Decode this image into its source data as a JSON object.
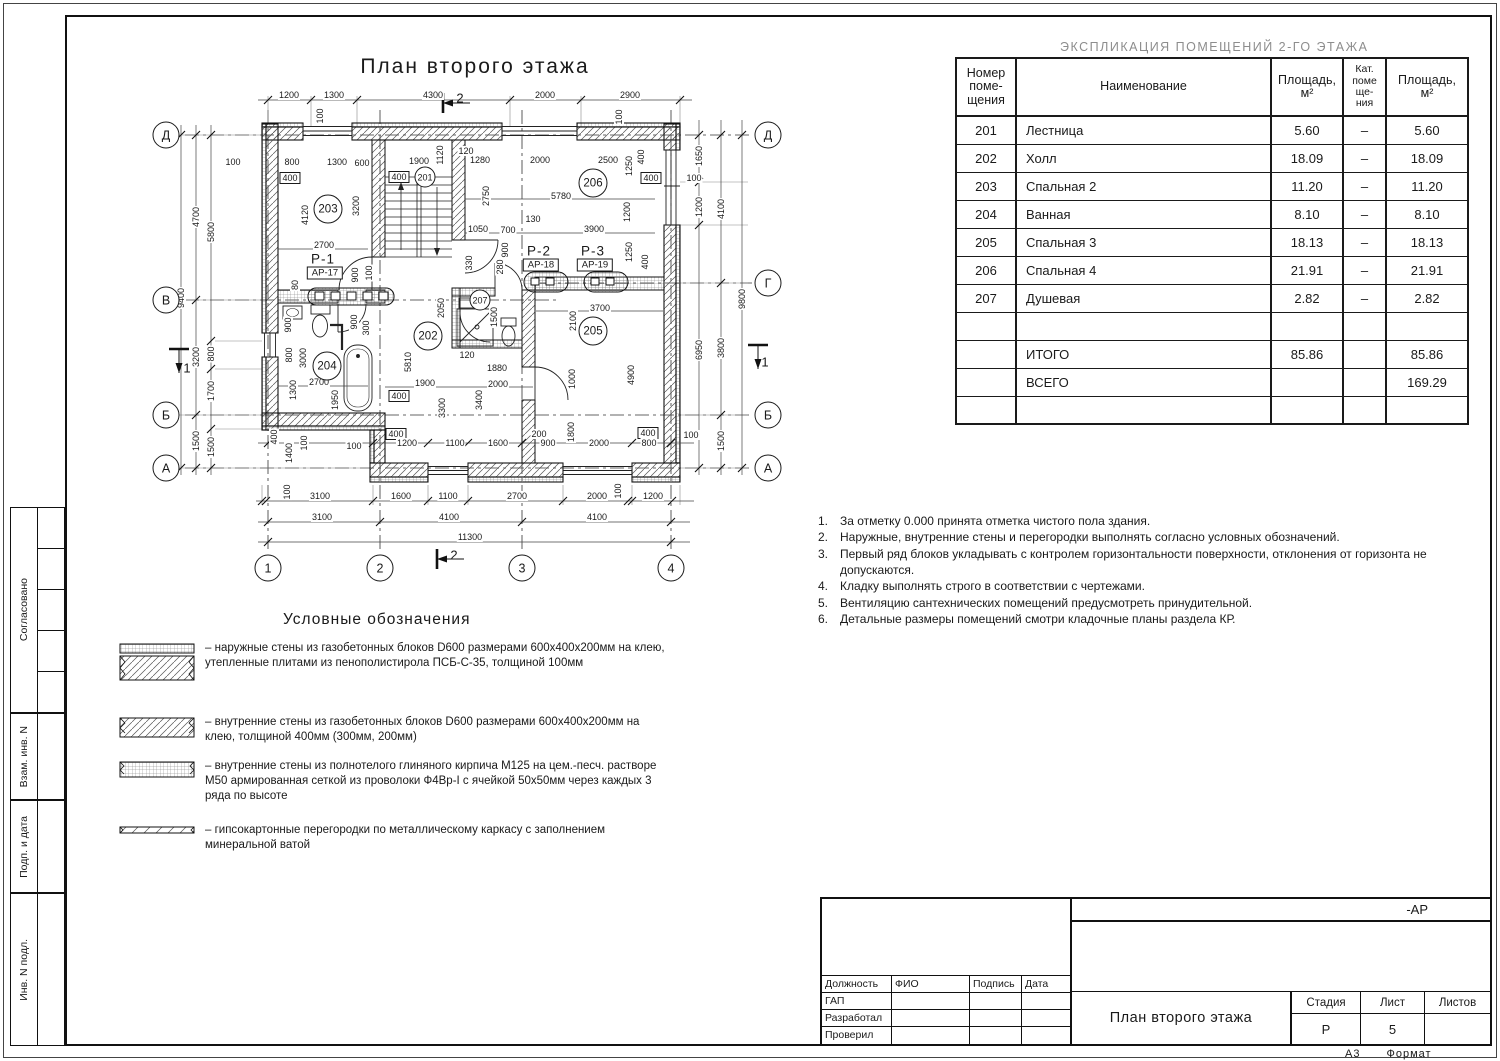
{
  "plan": {
    "title": "План второго этажа",
    "legend_title": "Условные обозначения",
    "axes": [
      {
        "t": "Д",
        "x": 166,
        "y": 135
      },
      {
        "t": "В",
        "x": 166,
        "y": 300
      },
      {
        "t": "Б",
        "x": 166,
        "y": 415
      },
      {
        "t": "А",
        "x": 166,
        "y": 468
      },
      {
        "t": "Д",
        "x": 768,
        "y": 135
      },
      {
        "t": "Г",
        "x": 768,
        "y": 283
      },
      {
        "t": "Б",
        "x": 768,
        "y": 415
      },
      {
        "t": "А",
        "x": 768,
        "y": 468
      },
      {
        "t": "1",
        "x": 268,
        "y": 568
      },
      {
        "t": "2",
        "x": 380,
        "y": 568
      },
      {
        "t": "3",
        "x": 522,
        "y": 568
      },
      {
        "t": "4",
        "x": 671,
        "y": 568
      }
    ],
    "rooms": [
      {
        "t": "201",
        "x": 425,
        "y": 177,
        "s": 1
      },
      {
        "t": "202",
        "x": 428,
        "y": 336
      },
      {
        "t": "203",
        "x": 328,
        "y": 209
      },
      {
        "t": "204",
        "x": 327,
        "y": 366
      },
      {
        "t": "205",
        "x": 593,
        "y": 331
      },
      {
        "t": "206",
        "x": 593,
        "y": 183
      },
      {
        "t": "207",
        "x": 480,
        "y": 300,
        "s": 1
      }
    ],
    "sections": [
      {
        "t": "Р-1",
        "ref": "АР-17",
        "x": 323,
        "y": 259
      },
      {
        "t": "Р-2",
        "ref": "АР-18",
        "x": 539,
        "y": 251
      },
      {
        "t": "Р-3",
        "ref": "АР-19",
        "x": 593,
        "y": 251
      }
    ],
    "cuts": [
      {
        "t": "2",
        "x": 460,
        "y": 98
      },
      {
        "t": "2",
        "x": 454,
        "y": 555
      },
      {
        "t": "1",
        "x": 187,
        "y": 368
      },
      {
        "t": "1",
        "x": 765,
        "y": 362
      }
    ],
    "dims": [
      {
        "t": "1200",
        "x": 289,
        "y": 95
      },
      {
        "t": "1300",
        "x": 334,
        "y": 95
      },
      {
        "t": "4300",
        "x": 433,
        "y": 95
      },
      {
        "t": "2000",
        "x": 545,
        "y": 95
      },
      {
        "t": "2900",
        "x": 630,
        "y": 95
      },
      {
        "t": "9400",
        "x": 181,
        "y": 298,
        "r": 1
      },
      {
        "t": "4700",
        "x": 196,
        "y": 217,
        "r": 1
      },
      {
        "t": "3200",
        "x": 196,
        "y": 357,
        "r": 1
      },
      {
        "t": "1500",
        "x": 196,
        "y": 441,
        "r": 1
      },
      {
        "t": "5800",
        "x": 211,
        "y": 232,
        "r": 1
      },
      {
        "t": "800",
        "x": 211,
        "y": 354,
        "r": 1
      },
      {
        "t": "1700",
        "x": 211,
        "y": 391,
        "r": 1
      },
      {
        "t": "1500",
        "x": 211,
        "y": 447,
        "r": 1
      },
      {
        "t": "1650",
        "x": 699,
        "y": 156,
        "r": 1
      },
      {
        "t": "1200",
        "x": 699,
        "y": 207,
        "r": 1
      },
      {
        "t": "6950",
        "x": 699,
        "y": 350,
        "r": 1
      },
      {
        "t": "4100",
        "x": 721,
        "y": 209,
        "r": 1
      },
      {
        "t": "3800",
        "x": 721,
        "y": 348,
        "r": 1
      },
      {
        "t": "1500",
        "x": 721,
        "y": 441,
        "r": 1
      },
      {
        "t": "9800",
        "x": 742,
        "y": 299,
        "r": 1
      },
      {
        "t": "100",
        "x": 287,
        "y": 492,
        "r": 1
      },
      {
        "t": "3100",
        "x": 320,
        "y": 496
      },
      {
        "t": "1600",
        "x": 401,
        "y": 496
      },
      {
        "t": "1100",
        "x": 448,
        "y": 496
      },
      {
        "t": "2700",
        "x": 517,
        "y": 496
      },
      {
        "t": "2000",
        "x": 597,
        "y": 496
      },
      {
        "t": "100",
        "x": 618,
        "y": 491,
        "r": 1
      },
      {
        "t": "1200",
        "x": 653,
        "y": 496
      },
      {
        "t": "3100",
        "x": 322,
        "y": 517
      },
      {
        "t": "4100",
        "x": 449,
        "y": 517
      },
      {
        "t": "4100",
        "x": 597,
        "y": 517
      },
      {
        "t": "11300",
        "x": 470,
        "y": 537
      },
      {
        "t": "100",
        "x": 233,
        "y": 162
      },
      {
        "t": "800",
        "x": 292,
        "y": 162
      },
      {
        "t": "400",
        "x": 290,
        "y": 178,
        "b": 1
      },
      {
        "t": "1300",
        "x": 337,
        "y": 162
      },
      {
        "t": "600",
        "x": 362,
        "y": 163
      },
      {
        "t": "1900",
        "x": 419,
        "y": 161
      },
      {
        "t": "400",
        "x": 399,
        "y": 177,
        "b": 1
      },
      {
        "t": "1120",
        "x": 440,
        "y": 155,
        "r": 1
      },
      {
        "t": "120",
        "x": 466,
        "y": 151
      },
      {
        "t": "1280",
        "x": 480,
        "y": 160
      },
      {
        "t": "2000",
        "x": 540,
        "y": 160
      },
      {
        "t": "2500",
        "x": 608,
        "y": 160
      },
      {
        "t": "1250",
        "x": 629,
        "y": 166,
        "r": 1
      },
      {
        "t": "400",
        "x": 641,
        "y": 157,
        "r": 1
      },
      {
        "t": "100",
        "x": 320,
        "y": 116,
        "r": 1
      },
      {
        "t": "100",
        "x": 619,
        "y": 117,
        "r": 1
      },
      {
        "t": "400",
        "x": 651,
        "y": 178,
        "b": 1
      },
      {
        "t": "100",
        "x": 694,
        "y": 178
      },
      {
        "t": "5780",
        "x": 561,
        "y": 196
      },
      {
        "t": "2750",
        "x": 486,
        "y": 196,
        "r": 1
      },
      {
        "t": "3200",
        "x": 356,
        "y": 206,
        "r": 1
      },
      {
        "t": "4120",
        "x": 305,
        "y": 215,
        "r": 1
      },
      {
        "t": "1200",
        "x": 627,
        "y": 212,
        "r": 1
      },
      {
        "t": "2700",
        "x": 324,
        "y": 245
      },
      {
        "t": "130",
        "x": 533,
        "y": 219
      },
      {
        "t": "1050",
        "x": 478,
        "y": 229
      },
      {
        "t": "700",
        "x": 508,
        "y": 230
      },
      {
        "t": "3900",
        "x": 594,
        "y": 229
      },
      {
        "t": "900",
        "x": 505,
        "y": 250,
        "r": 1
      },
      {
        "t": "1250",
        "x": 629,
        "y": 252,
        "r": 1
      },
      {
        "t": "400",
        "x": 645,
        "y": 262,
        "r": 1
      },
      {
        "t": "330",
        "x": 469,
        "y": 263,
        "r": 1
      },
      {
        "t": "280",
        "x": 500,
        "y": 267,
        "r": 1
      },
      {
        "t": "900",
        "x": 355,
        "y": 275,
        "r": 1
      },
      {
        "t": "100",
        "x": 369,
        "y": 273,
        "r": 1
      },
      {
        "t": "80",
        "x": 295,
        "y": 285,
        "r": 1
      },
      {
        "t": "900",
        "x": 288,
        "y": 325,
        "r": 1
      },
      {
        "t": "900",
        "x": 354,
        "y": 322,
        "r": 1
      },
      {
        "t": "300",
        "x": 366,
        "y": 328,
        "r": 1
      },
      {
        "t": "2050",
        "x": 441,
        "y": 308,
        "r": 1
      },
      {
        "t": "1500",
        "x": 494,
        "y": 317,
        "r": 1
      },
      {
        "t": "3700",
        "x": 600,
        "y": 308
      },
      {
        "t": "2100",
        "x": 573,
        "y": 321,
        "r": 1
      },
      {
        "t": "800",
        "x": 289,
        "y": 355,
        "r": 1
      },
      {
        "t": "3000",
        "x": 303,
        "y": 358,
        "r": 1
      },
      {
        "t": "5810",
        "x": 408,
        "y": 362,
        "r": 1
      },
      {
        "t": "120",
        "x": 467,
        "y": 355
      },
      {
        "t": "2700",
        "x": 319,
        "y": 382
      },
      {
        "t": "1300",
        "x": 293,
        "y": 390,
        "r": 1
      },
      {
        "t": "1950",
        "x": 335,
        "y": 400,
        "r": 1
      },
      {
        "t": "400",
        "x": 399,
        "y": 396,
        "b": 1
      },
      {
        "t": "1900",
        "x": 425,
        "y": 383
      },
      {
        "t": "1880",
        "x": 497,
        "y": 368
      },
      {
        "t": "2000",
        "x": 498,
        "y": 384
      },
      {
        "t": "1000",
        "x": 572,
        "y": 379,
        "r": 1
      },
      {
        "t": "3300",
        "x": 442,
        "y": 408,
        "r": 1
      },
      {
        "t": "3400",
        "x": 479,
        "y": 400,
        "r": 1
      },
      {
        "t": "4900",
        "x": 631,
        "y": 375,
        "r": 1
      },
      {
        "t": "400",
        "x": 274,
        "y": 437,
        "r": 1
      },
      {
        "t": "100",
        "x": 304,
        "y": 443,
        "r": 1
      },
      {
        "t": "1400",
        "x": 289,
        "y": 453,
        "r": 1
      },
      {
        "t": "100",
        "x": 354,
        "y": 446
      },
      {
        "t": "400",
        "x": 396,
        "y": 434,
        "b": 1
      },
      {
        "t": "1200",
        "x": 407,
        "y": 443
      },
      {
        "t": "1100",
        "x": 455,
        "y": 443
      },
      {
        "t": "1600",
        "x": 498,
        "y": 443
      },
      {
        "t": "200",
        "x": 539,
        "y": 434
      },
      {
        "t": "900",
        "x": 548,
        "y": 443
      },
      {
        "t": "1800",
        "x": 571,
        "y": 432,
        "r": 1
      },
      {
        "t": "2000",
        "x": 599,
        "y": 443
      },
      {
        "t": "400",
        "x": 648,
        "y": 433,
        "b": 1
      },
      {
        "t": "800",
        "x": 649,
        "y": 443
      },
      {
        "t": "100",
        "x": 691,
        "y": 435
      }
    ]
  },
  "explication": {
    "title": "ЭКСПЛИКАЦИЯ  ПОМЕЩЕНИЙ  2-ГО  ЭТАЖА",
    "headers": [
      "Номер\nпоме-\nщения",
      "Наименование",
      "Площадь,\nм²",
      "Кат.\nпоме\nще-\nния",
      "Площадь,\nм²"
    ],
    "rows": [
      [
        "201",
        "Лестница",
        "5.60",
        "–",
        "5.60"
      ],
      [
        "202",
        "Холл",
        "18.09",
        "–",
        "18.09"
      ],
      [
        "203",
        "Спальная 2",
        "11.20",
        "–",
        "11.20"
      ],
      [
        "204",
        "Ванная",
        "8.10",
        "–",
        "8.10"
      ],
      [
        "205",
        "Спальная 3",
        "18.13",
        "–",
        "18.13"
      ],
      [
        "206",
        "Спальная 4",
        "21.91",
        "–",
        "21.91"
      ],
      [
        "207",
        "Душевая",
        "2.82",
        "–",
        "2.82"
      ],
      [
        "",
        "",
        "",
        "",
        ""
      ],
      [
        "",
        "ИТОГО",
        "85.86",
        "",
        "85.86"
      ],
      [
        "",
        "ВСЕГО",
        "",
        "",
        "169.29"
      ],
      [
        "",
        "",
        "",
        "",
        ""
      ]
    ]
  },
  "notes": {
    "items": [
      "За отметку 0.000 принята отметка чистого пола здания.",
      "Наружные, внутренние стены и перегородки выполнять согласно условных обозначений.",
      "Первый ряд блоков укладывать с контролем горизонтальности поверхности, отклонения от горизонта не допускаются.",
      "Кладку выполнять строго в соответствии с чертежами.",
      "Вентиляцию сантехнических помещений  предусмотреть принудительной.",
      "Детальные размеры помещений смотри кладочные планы раздела КР."
    ]
  },
  "legend": {
    "items": [
      "–  наружные стены из газобетонных блоков D600 размерами 600х400х200мм  на клею, утепленные плитами из пенополистирола ПСБ-С-35, толщиной 100мм",
      "–  внутренние стены из газобетонных блоков D600 размерами 600х400х200мм  на клею, толщиной 400мм (300мм, 200мм)",
      "–  внутренние стены из полнотелого глиняного кирпича М125 на цем.-песч. растворе М50 армированная сеткой из проволоки Ф4Вр-I с ячейкой 50х50мм через каждых 3 ряда по высоте",
      "–  гипсокартонные перегородки по металлическому каркасу с заполнением минеральной ватой"
    ]
  },
  "title_block": {
    "code": "-АР",
    "col_headers": [
      "Должность",
      "ФИО",
      "Подпись",
      "Дата"
    ],
    "role_rows": [
      "ГАП",
      "Разработал",
      "Проверил"
    ],
    "doc_title": "План второго этажа",
    "stage_header": "Стадия",
    "sheet_header": "Лист",
    "sheets_header": "Листов",
    "stage": "Р",
    "sheet": "5",
    "sheets": "",
    "format": "А3",
    "format_label": "Формат"
  },
  "side_stamp": {
    "top_label": "Согласовано",
    "labels": [
      "Взам. инв. N",
      "Подп. и дата",
      "Инв. N подл."
    ]
  }
}
